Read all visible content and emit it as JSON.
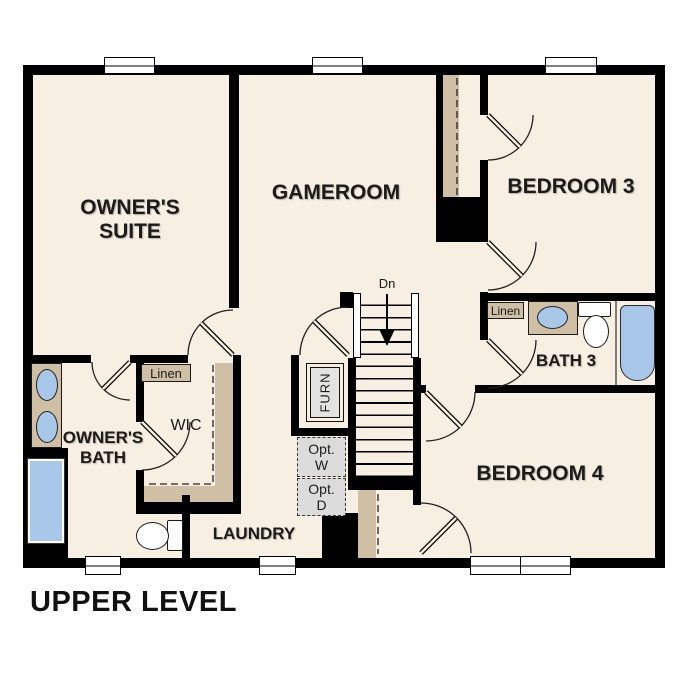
{
  "floor_title": "UPPER LEVEL",
  "rooms": {
    "owners_suite": {
      "line1": "OWNER'S",
      "line2": "SUITE"
    },
    "gameroom": {
      "label": "GAMEROOM"
    },
    "bedroom3": {
      "label": "BEDROOM 3"
    },
    "bath3": {
      "label": "BATH 3"
    },
    "bedroom4": {
      "label": "BEDROOM 4"
    },
    "owners_bath": {
      "line1": "OWNER'S",
      "line2": "BATH"
    },
    "wic": {
      "label": "WIC"
    },
    "laundry": {
      "label": "LAUNDRY"
    }
  },
  "closets": {
    "wic_linen": "Linen",
    "bath3_linen": "Linen",
    "furnace": "FURN"
  },
  "optional_appliances": {
    "washer": {
      "line1": "Opt.",
      "line2": "W"
    },
    "dryer": {
      "line1": "Opt.",
      "line2": "D"
    }
  },
  "stairs": {
    "direction": "Dn"
  },
  "colors": {
    "floor": "#f6efe2",
    "wall": "#000000",
    "counter_tan": "#cfc0a5",
    "fixture_blue": "#a9c8e9",
    "optional_gray": "#dcdcdc",
    "background": "#ffffff"
  }
}
